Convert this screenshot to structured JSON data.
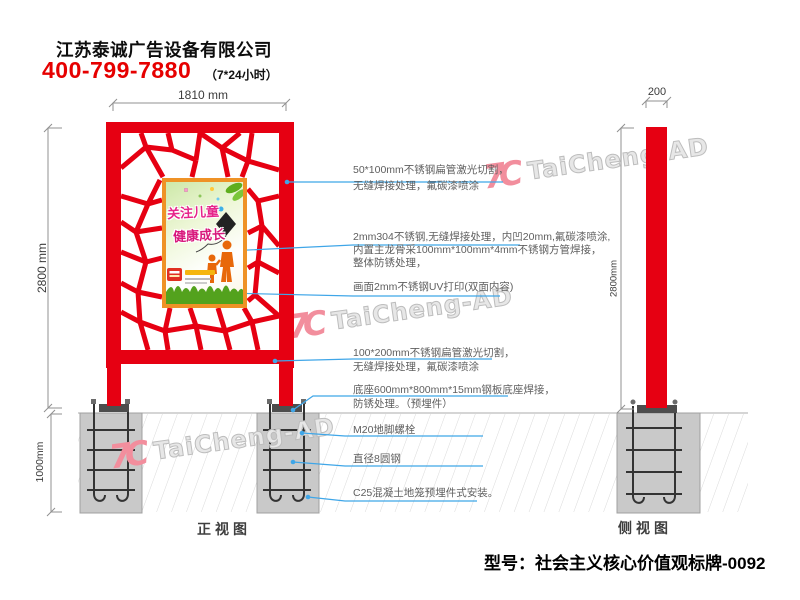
{
  "header": {
    "company": "江苏泰诚广告设备有限公司",
    "phone": "400-799-7880",
    "hours": "（7*24小时）"
  },
  "dimensions": {
    "front_width": "1810 mm",
    "front_height": "2800 mm",
    "foundation_depth": "1000mm",
    "side_width": "200",
    "side_height": "2800mm"
  },
  "annotations": [
    {
      "lines": [
        "50*100mm不锈钢扁管激光切割，",
        "无缝焊接处理，氟碳漆喷涂"
      ]
    },
    {
      "lines": [
        "2mm304不锈钢,无缝焊接处理，内凹20mm,氟碳漆喷涂,",
        "内置主龙骨采100mm*100mm*4mm不锈钢方管焊接，",
        "整体防锈处理，"
      ]
    },
    {
      "lines": [
        "画面2mm不锈钢UV打印(双面内容)"
      ]
    },
    {
      "lines": [
        "100*200mm不锈钢扁管激光切割，",
        "无缝焊接处理，氟碳漆喷涂"
      ]
    },
    {
      "lines": [
        "底座600mm*800mm*15mm钢板底座焊接，",
        "防锈处理。（预埋件）"
      ]
    },
    {
      "lines": [
        "M20地脚螺栓"
      ]
    },
    {
      "lines": [
        "直径8圆钢"
      ]
    },
    {
      "lines": [
        "C25混凝土地笼预埋件式安装。"
      ]
    }
  ],
  "poster": {
    "title_line1": "关注儿童",
    "title_line2": "健康成长"
  },
  "views": {
    "front_label": "正视图",
    "side_label": "侧视图"
  },
  "watermark": {
    "logo": "7C",
    "text": "TaiCheng-AD"
  },
  "footer": {
    "model": "型号：社会主义核心价值观标牌-0092"
  },
  "colors": {
    "structure_red": "#e60012",
    "leader_blue": "#3fa6e8",
    "phone_red": "#e60000",
    "foundation_gray": "#c9c9c9"
  }
}
